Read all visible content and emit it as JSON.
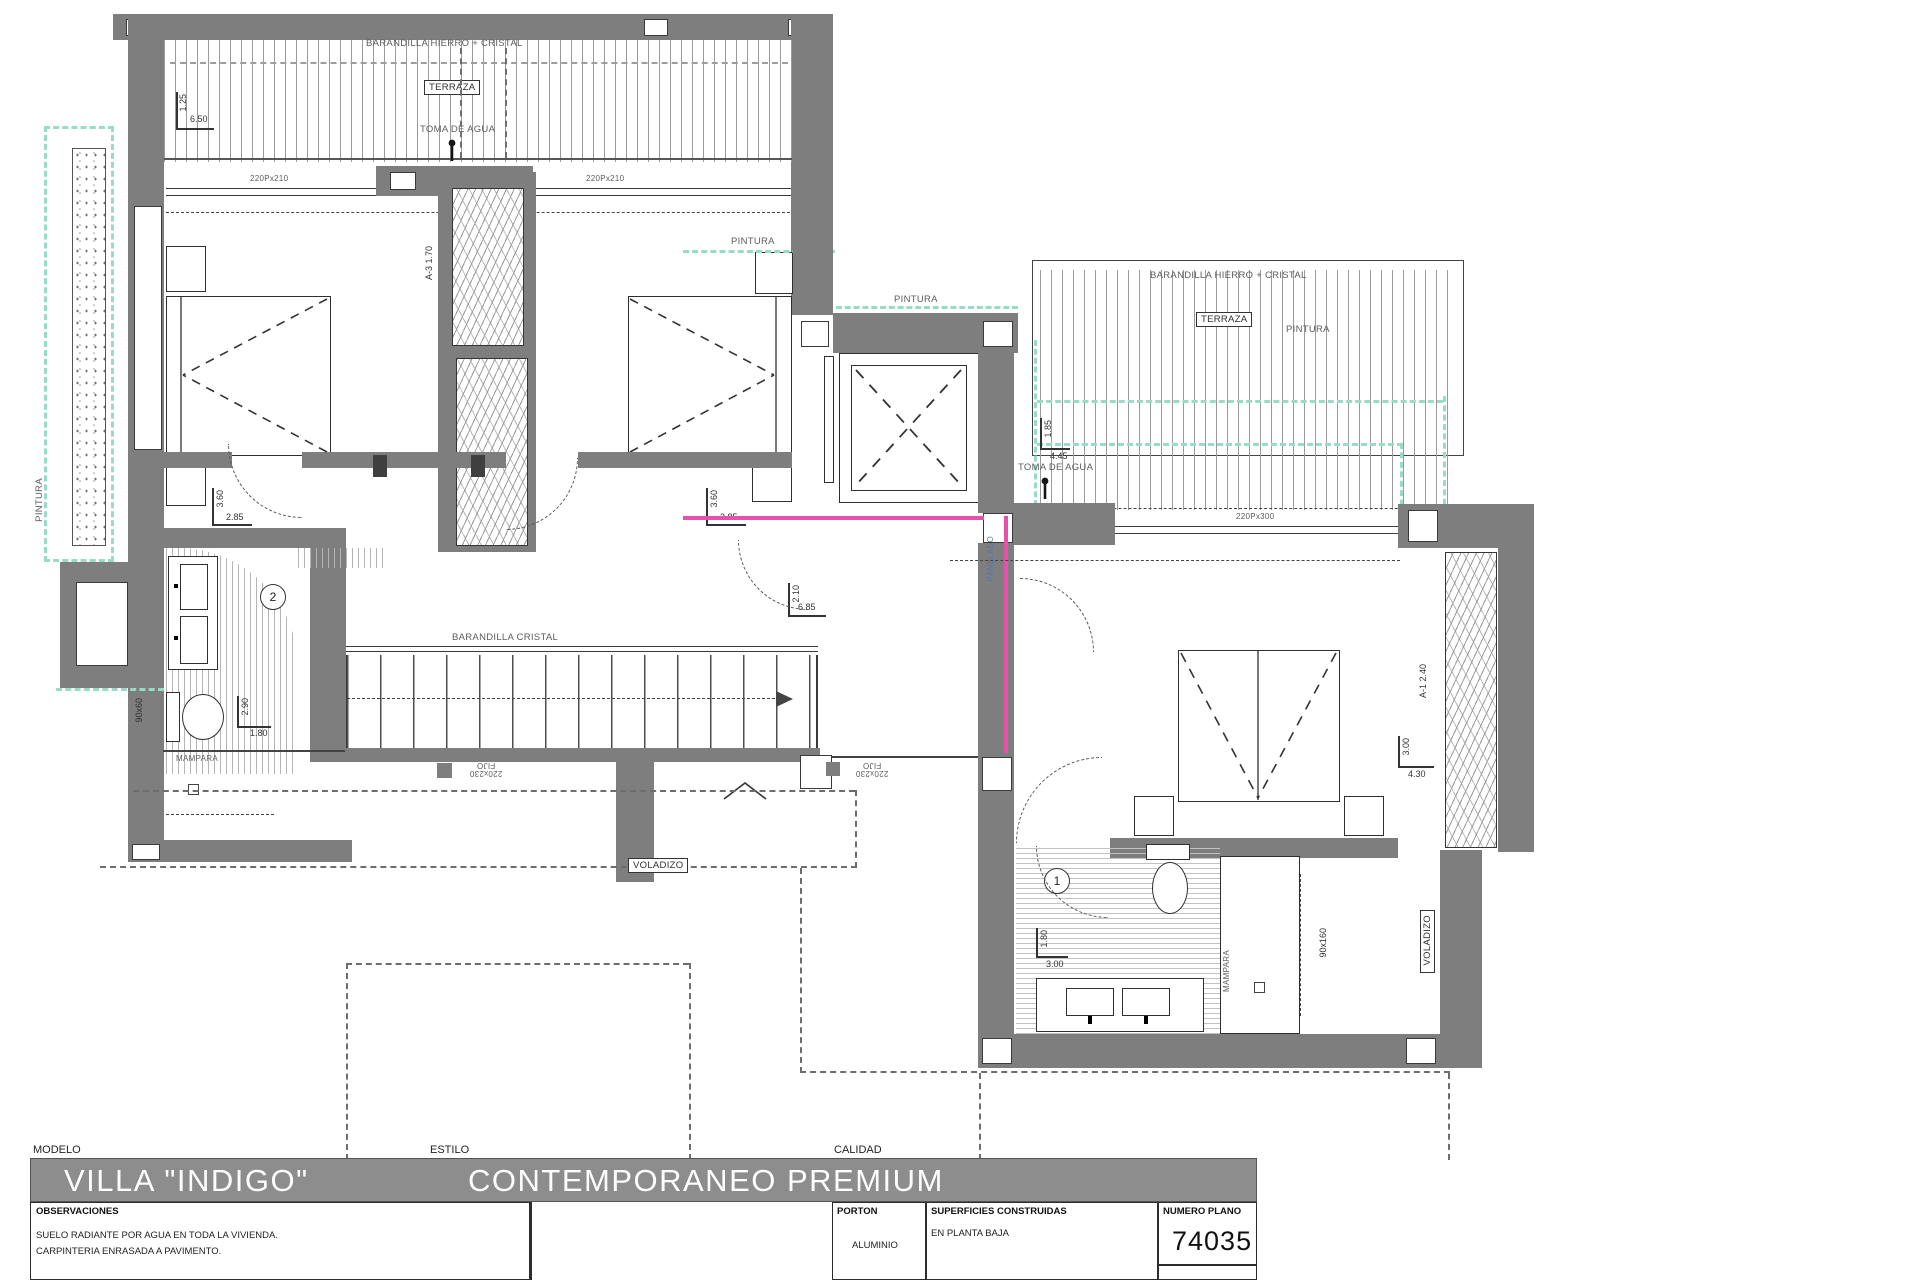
{
  "sheet": {
    "modelo_label": "MODELO",
    "modelo_value": "VILLA \"INDIGO\"",
    "estilo_label": "ESTILO",
    "estilo_value": "CONTEMPORANEO  PREMIUM",
    "calidad_label": "CALIDAD",
    "observaciones_label": "OBSERVACIONES",
    "observaciones_line1": "SUELO RADIANTE POR AGUA EN TODA LA VIVIENDA.",
    "observaciones_line2": "CARPINTERIA ENRASADA A PAVIMENTO.",
    "porton_label": "PORTON",
    "porton_value": "ALUMINIO",
    "superficies_label": "SUPERFICIES CONSTRUIDAS",
    "superficies_value": "EN PLANTA BAJA",
    "numero_label": "NUMERO PLANO",
    "numero_value": "74035"
  },
  "plan": {
    "labels": {
      "barandilla_hierro": "BARANDILLA HIERRO + CRISTAL",
      "terraza": "TERRAZA",
      "toma_de_agua": "TOMA DE AGUA",
      "win_220x210": "220Px210",
      "win_220x300": "220Px300",
      "pintura": "PINTURA",
      "barandilla_cristal": "BARANDILLA CRISTAL",
      "mampara": "MAMPARA",
      "fijo_size": "220x230",
      "fijo": "FIJO",
      "voladizo": "VOLADIZO",
      "panelado": "PANELADO",
      "size_90x160": "90x160",
      "size_90x60": "90x60",
      "wardrobe_a3": "A-3  1.70",
      "wardrobe_a1": "A-1  2.40",
      "room_1": "1",
      "room_2": "2"
    },
    "dims": {
      "terrace_left_v": "1.25",
      "terrace_left_h": "6.50",
      "bedroom1_v": "3.60",
      "bedroom1_h": "2.85",
      "bedroom2_v": "3.60",
      "bedroom2_h": "2.85",
      "bath2_v": "2.90",
      "bath2_h": "1.80",
      "hall_v": "2.10",
      "hall_h": "6.85",
      "terrace_right_v": "1.85",
      "terrace_right_h": "4.45",
      "master_v": "3.00",
      "master_h": "4.30",
      "bath1_v": "1.80",
      "bath1_h": "3.00"
    }
  }
}
